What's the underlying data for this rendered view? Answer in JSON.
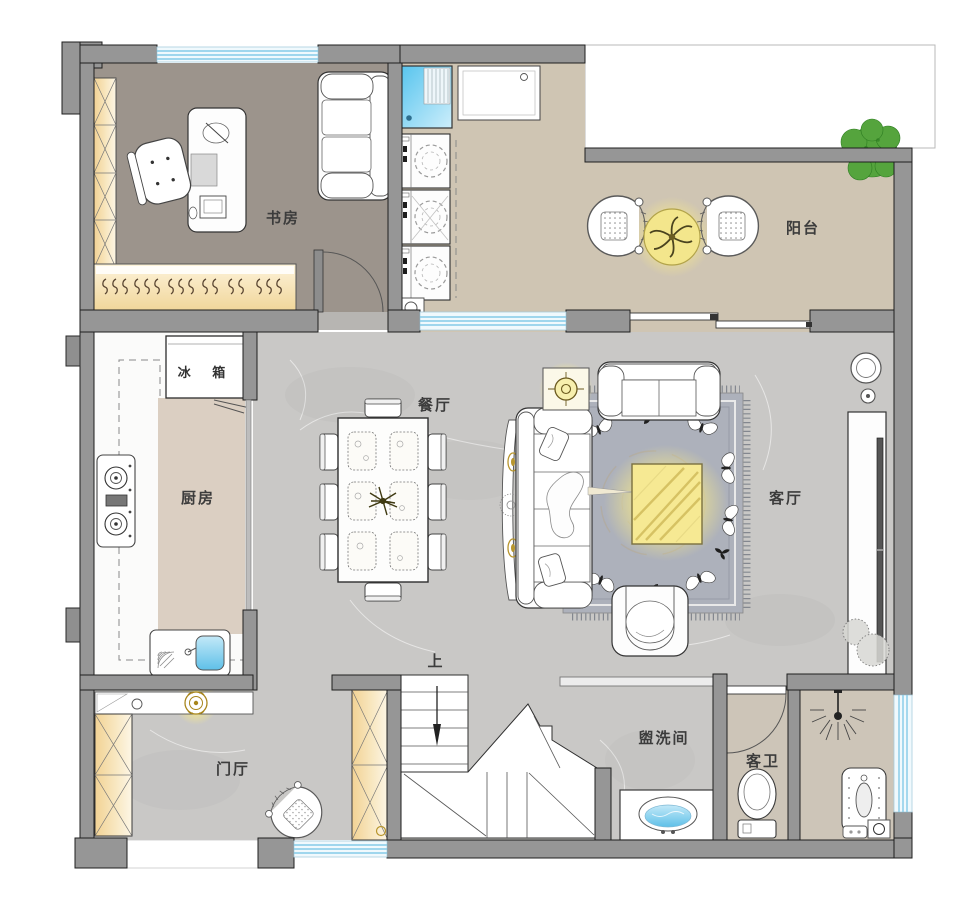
{
  "plan": {
    "title": "residential floor plan",
    "rooms": {
      "study": {
        "label": "书房"
      },
      "balcony": {
        "label": "阳台"
      },
      "kitchen": {
        "label": "厨房"
      },
      "dining": {
        "label": "餐厅"
      },
      "living": {
        "label": "客厅"
      },
      "foyer": {
        "label": "门厅"
      },
      "washroom": {
        "label": "盥洗间"
      },
      "guest_bath": {
        "label": "客卫"
      },
      "stairs": {
        "label": "上"
      }
    },
    "appliances": {
      "fridge": {
        "label": "冰 箱"
      }
    },
    "colors": {
      "wall": "#969696",
      "wall_outline": "#1f1f1f",
      "marble_floor": "#c9c8c6",
      "study_floor": "#9c948c",
      "balcony_floor": "#cfc5b3",
      "kitchen_floor": "#dbcfc2",
      "bath_floor": "#cdc5b8",
      "cabinet_wood": "#f3d79b",
      "glow_yellow": "#f6e88a",
      "window_glass": "#84cbe8",
      "rug": "#adb1bb",
      "plant_green": "#55a43d"
    },
    "fixtures": [
      "desk",
      "office-chair",
      "study-sofa",
      "wardrobe",
      "coat-hanger-rack",
      "mop-sink",
      "washing-machine",
      "laundry-sink",
      "rattan-chair",
      "round-tea-table",
      "potted-tree",
      "refrigerator",
      "gas-stove",
      "kitchen-sink",
      "dining-table",
      "dining-chair",
      "placemat",
      "sofa-3-seat",
      "sofa-2-seat",
      "armchair",
      "coffee-table",
      "lamp-side-table",
      "area-rug",
      "tv-cabinet",
      "tv",
      "stair-flight",
      "stair-direction-arrow",
      "shoe-console",
      "ceiling-lamp",
      "vanity-basin",
      "toilet",
      "shower-head",
      "squat-pan",
      "floor-drain",
      "sliding-door",
      "swing-door",
      "window"
    ]
  }
}
